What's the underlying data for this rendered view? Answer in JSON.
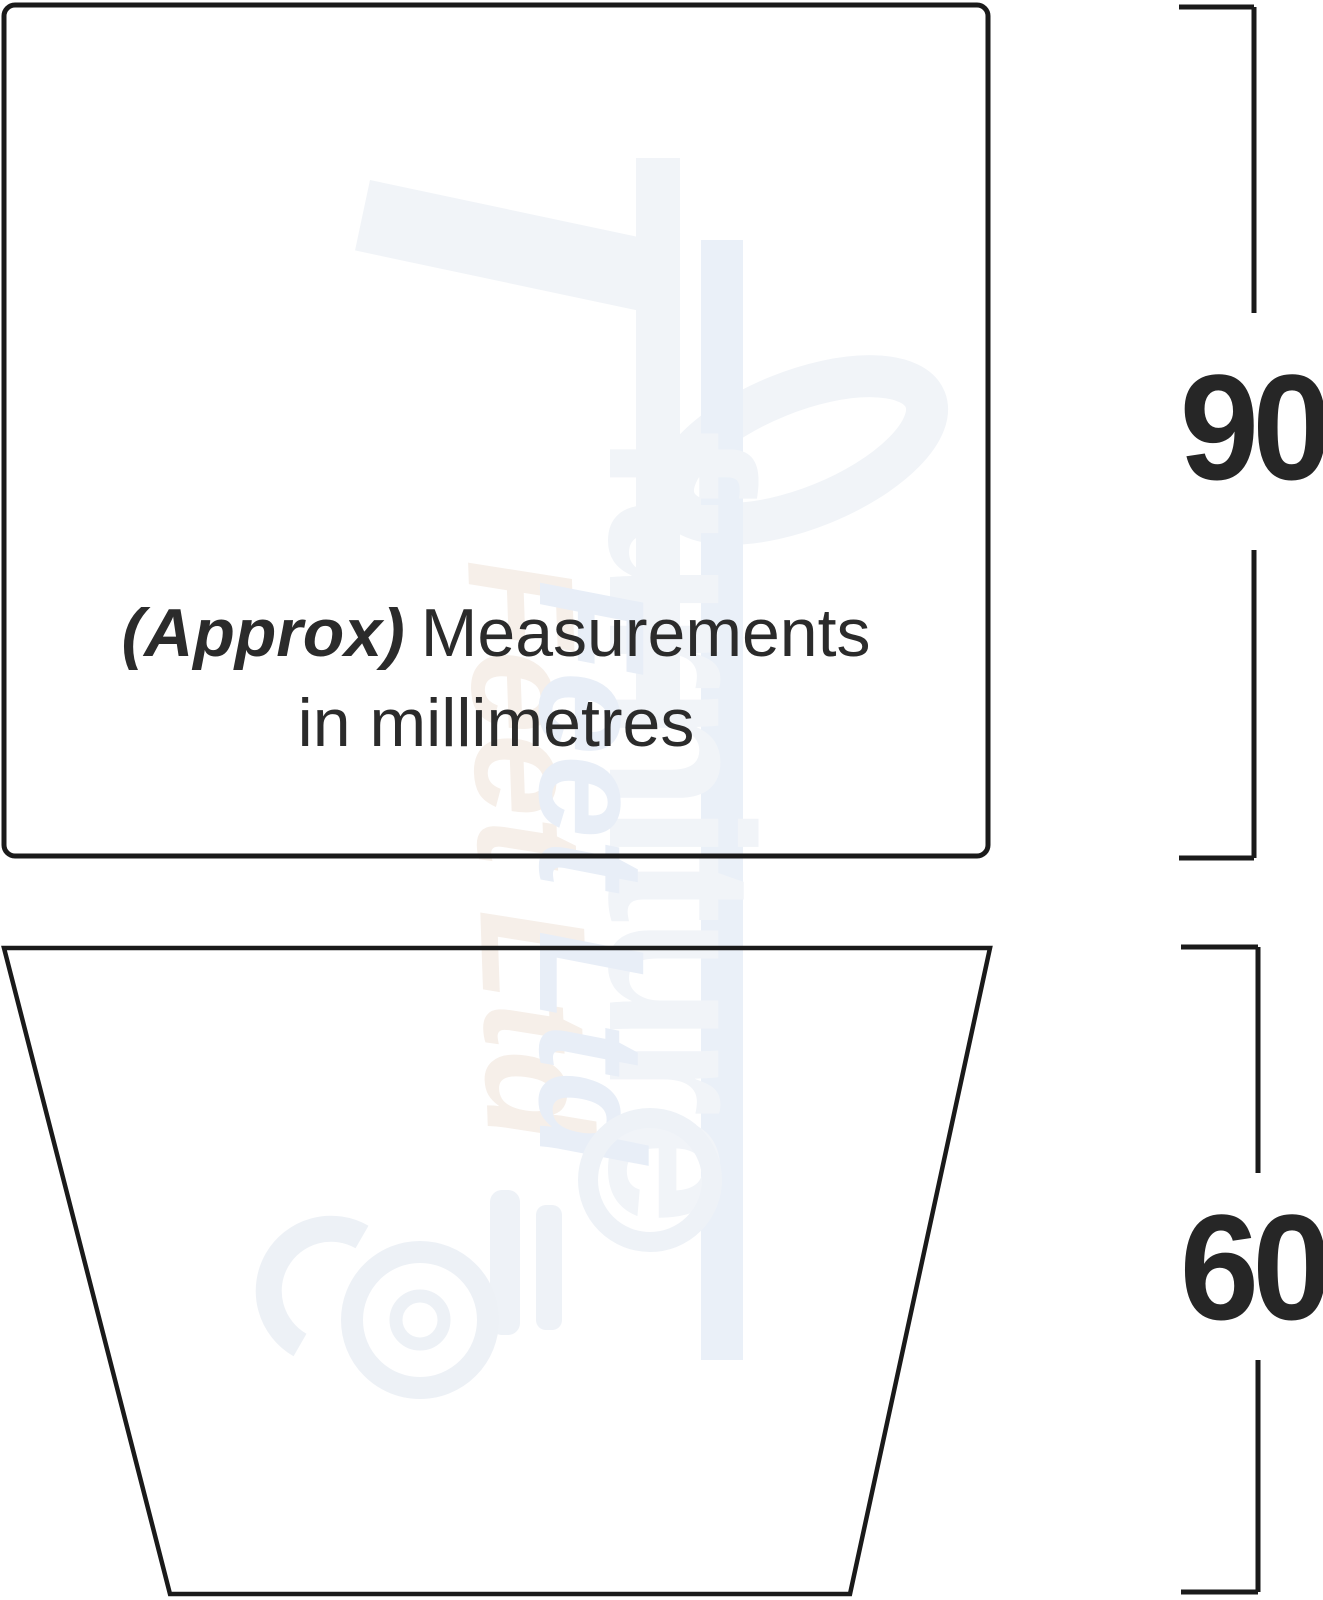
{
  "note": {
    "approx": "(Approx)",
    "rest": "Measurements",
    "line2": "in millimetres"
  },
  "dimensions": {
    "top_shape_height_mm": "90",
    "bottom_shape_height_mm": "60"
  },
  "watermark": {
    "brand_word": "furniture",
    "brand_sub": "Feet Ltd"
  },
  "colors": {
    "outline": "#1a1a1a",
    "note_text": "#2b2b2b",
    "dimension_text": "#262626",
    "watermark_gray": "#f1f4f8",
    "watermark_blue": "#e8eef7",
    "watermark_pink": "#f6efe9"
  }
}
